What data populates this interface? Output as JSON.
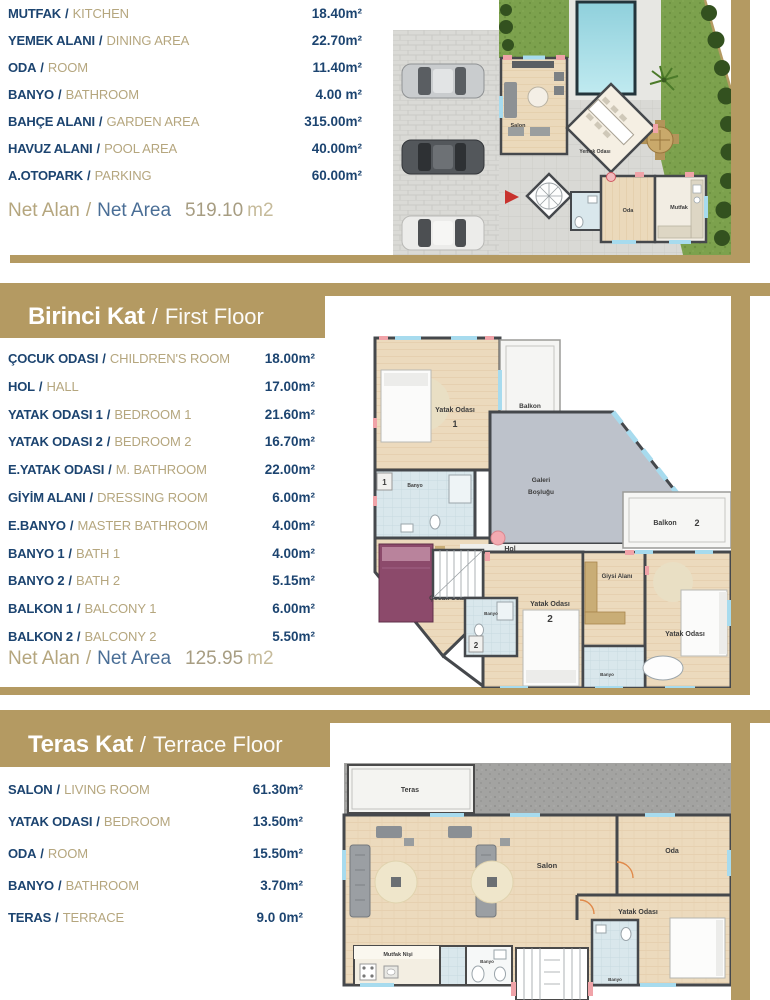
{
  "ui": {
    "separator": "/"
  },
  "colors": {
    "frame": "#b49a62",
    "label_tr": "#1c4470",
    "label_en": "#b5a67e",
    "net_blue": "#4a6e96"
  },
  "sections": [
    {
      "rooms": [
        {
          "tr": "MUTFAK",
          "en": "KITCHEN",
          "value": "18.40m²"
        },
        {
          "tr": "YEMEK ALANI",
          "en": "DINING AREA",
          "value": "22.70m²"
        },
        {
          "tr": "ODA",
          "en": "ROOM",
          "value": "11.40m²"
        },
        {
          "tr": "BANYO",
          "en": "BATHROOM",
          "value": "4.00 m²"
        },
        {
          "tr": "BAHÇE ALANI",
          "en": "GARDEN AREA",
          "value": "315.00m²"
        },
        {
          "tr": "HAVUZ ALANI",
          "en": "POOL AREA",
          "value": "40.00m²"
        },
        {
          "tr": "A.OTOPARK",
          "en": "PARKING",
          "value": "60.00m²"
        }
      ],
      "net": {
        "tr": "Net Alan",
        "en": "Net Area",
        "number": "519.10",
        "unit": "m2"
      }
    },
    {
      "header": {
        "tr": "Birinci Kat",
        "en": "First Floor"
      },
      "rooms": [
        {
          "tr": "ÇOCUK ODASI",
          "en": "CHILDREN'S ROOM",
          "value": "18.00m²"
        },
        {
          "tr": "HOL",
          "en": "HALL",
          "value": "17.00m²"
        },
        {
          "tr": "YATAK ODASI 1",
          "en": "BEDROOM 1",
          "value": "21.60m²"
        },
        {
          "tr": "YATAK ODASI 2",
          "en": "BEDROOM 2",
          "value": "16.70m²"
        },
        {
          "tr": "E.YATAK ODASI",
          "en": "M. BATHROOM",
          "value": "22.00m²"
        },
        {
          "tr": "GİYİM ALANI",
          "en": "DRESSING ROOM",
          "value": "6.00m²"
        },
        {
          "tr": "E.BANYO",
          "en": "MASTER BATHROOM",
          "value": "4.00m²"
        },
        {
          "tr": "BANYO 1",
          "en": "BATH 1",
          "value": "4.00m²"
        },
        {
          "tr": "BANYO 2",
          "en": "BATH 2",
          "value": "5.15m²"
        },
        {
          "tr": "BALKON 1",
          "en": "BALCONY 1",
          "value": "6.00m²"
        },
        {
          "tr": "BALKON 2",
          "en": "BALCONY 2",
          "value": "5.50m²"
        }
      ],
      "net": {
        "tr": "Net Alan",
        "en": "Net Area",
        "number": "125.95",
        "unit": "m2"
      }
    },
    {
      "header": {
        "tr": "Teras Kat",
        "en": "Terrace Floor"
      },
      "rooms": [
        {
          "tr": "SALON",
          "en": "LIVING ROOM",
          "value": "61.30m²"
        },
        {
          "tr": "YATAK ODASI",
          "en": "BEDROOM",
          "value": "13.50m²"
        },
        {
          "tr": "ODA",
          "en": "ROOM",
          "value": "15.50m²"
        },
        {
          "tr": "BANYO",
          "en": "BATHROOM",
          "value": "3.70m²"
        },
        {
          "tr": "TERAS",
          "en": "TERRACE",
          "value": "9.0 0m²"
        }
      ]
    }
  ],
  "plans": {
    "ground": {
      "salon": "Salon",
      "dining": "Yemek Odası",
      "oda": "Oda",
      "mutfak": "Mutfak"
    },
    "first": {
      "bed1": "Yatak Odası",
      "bed1num": "1",
      "balcony1": "Balkon",
      "balcony1num": "1",
      "bath1": "Banyo",
      "bath1num": "1",
      "kids": "Çocuk Odası",
      "hall": "Hol",
      "gallery1": "Galeri",
      "gallery2": "Boşluğu",
      "balcony2": "Balkon",
      "balcony2num": "2",
      "dressing": "Giysi Alanı",
      "bed2": "Yatak Odası",
      "bed2num": "2",
      "bath2": "Banyo",
      "bath2num": "2",
      "master": "Yatak Odası",
      "bath3": "Banyo"
    },
    "terrace": {
      "teras": "Teras",
      "salon": "Salon",
      "oda": "Oda",
      "bed": "Yatak Odası",
      "kitchen": "Mutfak Nişi",
      "bath1": "Banyo"
    }
  }
}
